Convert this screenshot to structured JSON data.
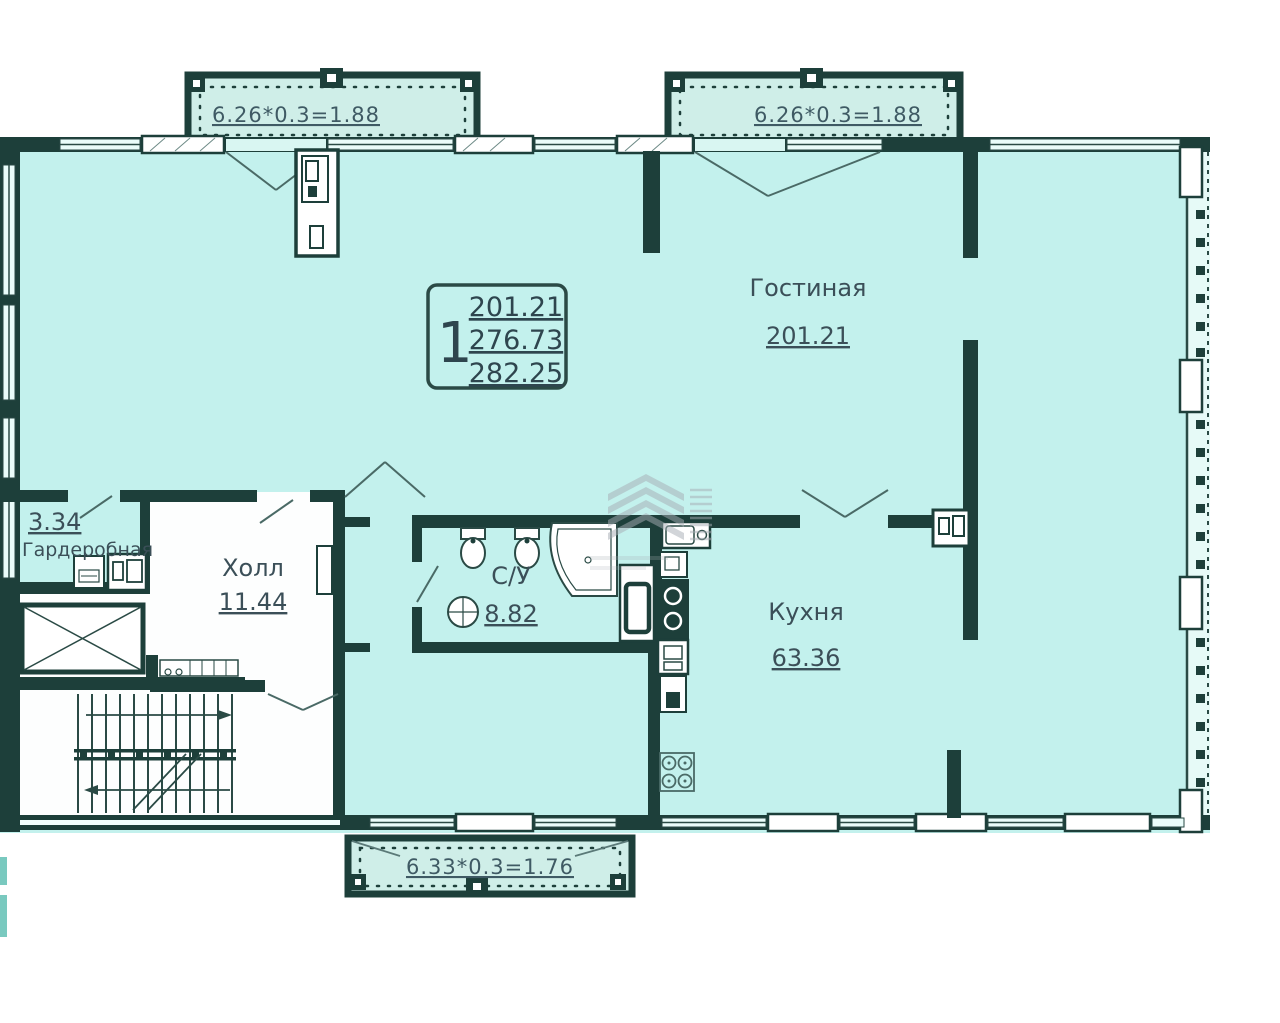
{
  "plan": {
    "unit_box": {
      "unit_number": "1",
      "area_line1": "201.21",
      "area_line2": "276.73",
      "area_line3": "282.25"
    },
    "rooms": [
      {
        "name": "Гостиная",
        "area": "201.21"
      },
      {
        "name": "Кухня",
        "area": "63.36"
      },
      {
        "name": "Холл",
        "area": "11.44"
      },
      {
        "name": "С/У",
        "area": "8.82"
      },
      {
        "name": "Гардеробная",
        "area": "3.34"
      }
    ],
    "balconies": [
      {
        "position": "top-left",
        "dimension": "6.26*0.3=1.88"
      },
      {
        "position": "top-right",
        "dimension": "6.26*0.3=1.88"
      },
      {
        "position": "bottom",
        "dimension": "6.33*0.3=1.76"
      }
    ],
    "colors": {
      "wall": "#1d3f3a",
      "room_fill": "#c3f1ed",
      "balcony_fill": "#cfeee8",
      "hall_fill": "#fdfefe",
      "label_text": "#3b4f58",
      "watermark": "#a7adb4"
    }
  }
}
